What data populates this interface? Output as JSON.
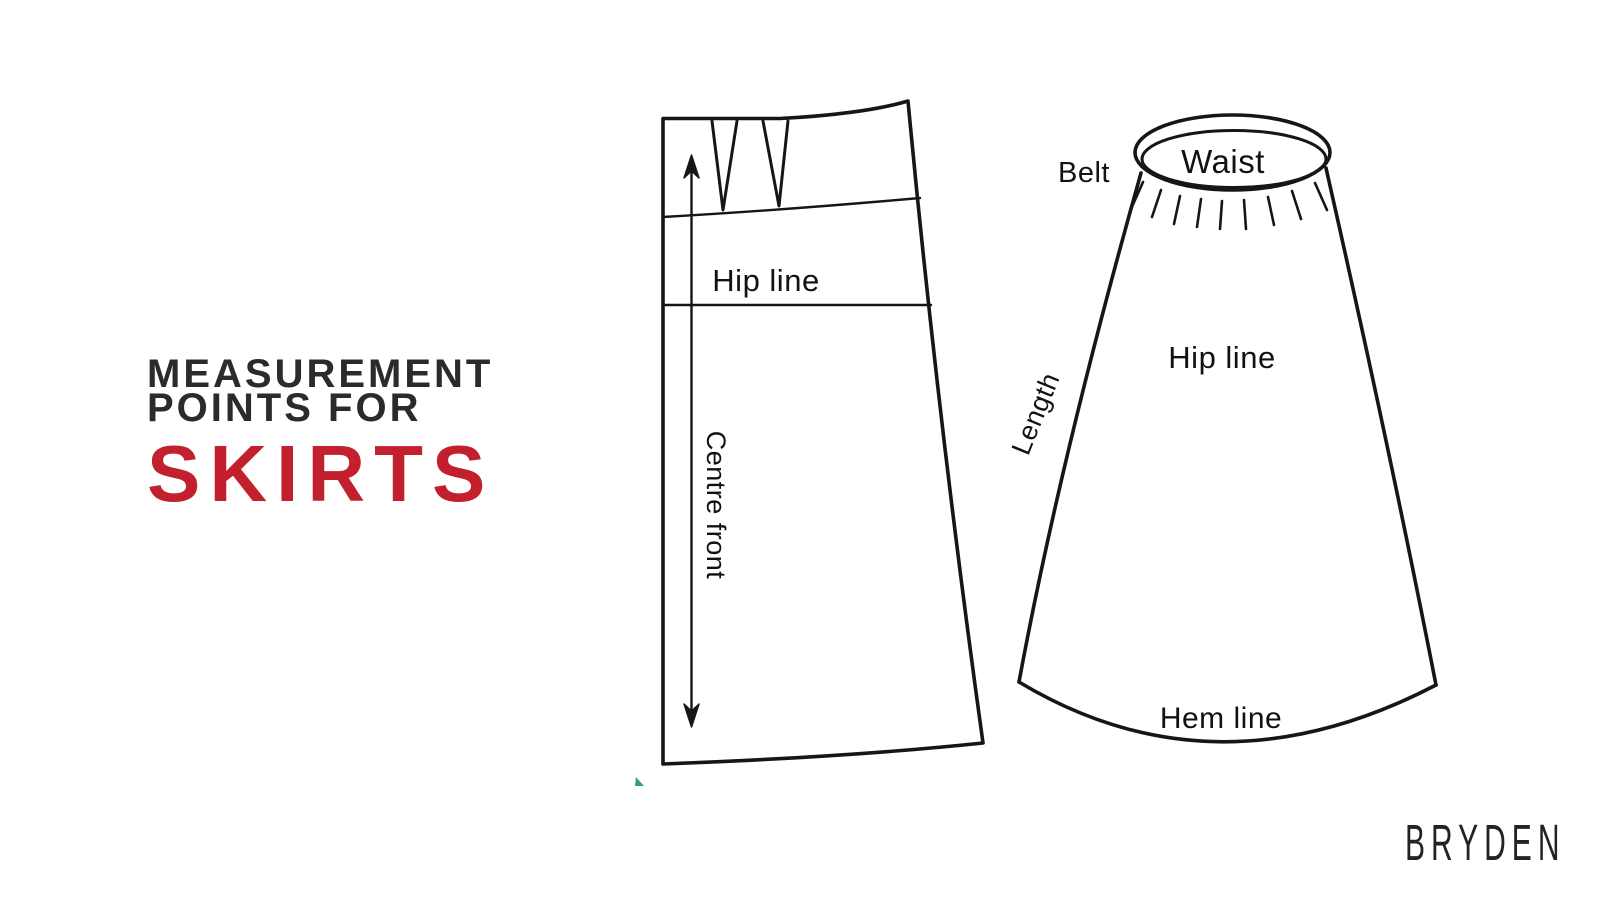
{
  "page": {
    "background_color": "#ffffff"
  },
  "title": {
    "line1": "MEASUREMENT",
    "line2": "POINTS FOR",
    "emphasis": "SKIRTS",
    "text_color": "#2d2a2b",
    "emphasis_color": "#c2202d"
  },
  "diagrams": {
    "ink_color": "#161616",
    "pattern_piece": {
      "description": "flat skirt pattern piece with two waist darts, vertical double-headed measurement arrow",
      "labels": {
        "hip_line": "Hip line",
        "centre_front": "Centre front"
      }
    },
    "skirt_front": {
      "description": "A-line skirt front view with waistband ellipse and gather lines",
      "labels": {
        "belt": "Belt",
        "waist": "Waist",
        "hip_line": "Hip line",
        "length": "Length",
        "hem_line": "Hem line"
      }
    }
  },
  "brand": {
    "logo_text": "BRYDEN",
    "color": "#232327"
  },
  "artifact": {
    "color": "#2aa08a"
  }
}
